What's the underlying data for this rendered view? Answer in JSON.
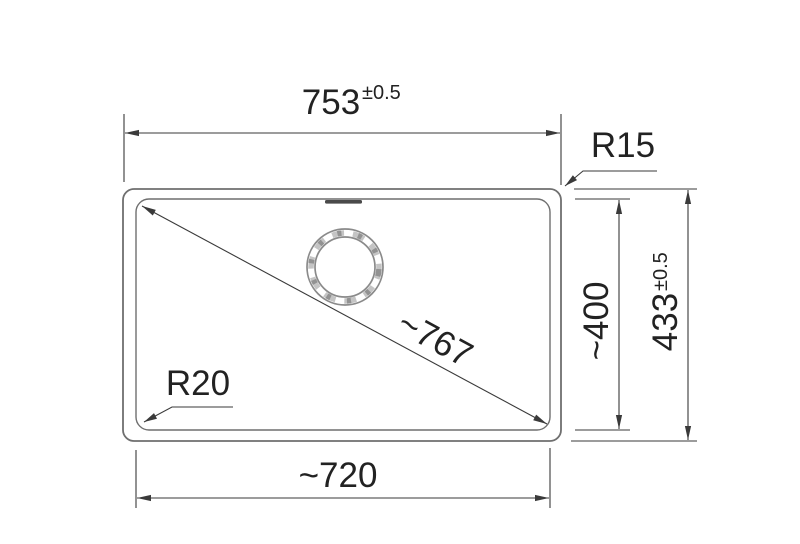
{
  "diagram": {
    "type": "technical-dimension-drawing",
    "subject": "sink bowl top view with dimensions",
    "dims": {
      "overall_width": {
        "value": "753",
        "tol": "±0.5"
      },
      "overall_depth": {
        "value": "433",
        "tol": "±0.5"
      },
      "bowl_width": {
        "value": "~720"
      },
      "bowl_depth": {
        "value": "~400"
      },
      "diagonal": {
        "value": "~767"
      },
      "outer_corner_radius": {
        "value": "R15"
      },
      "inner_corner_radius": {
        "value": "R20"
      }
    },
    "colors": {
      "background": "#ffffff",
      "outline": "#6f6f6f",
      "dimension_line": "#3a3a3a",
      "text": "#222222",
      "drain_ring": "#8a8a8a",
      "overflow_slot": "#4a4a4a"
    }
  }
}
